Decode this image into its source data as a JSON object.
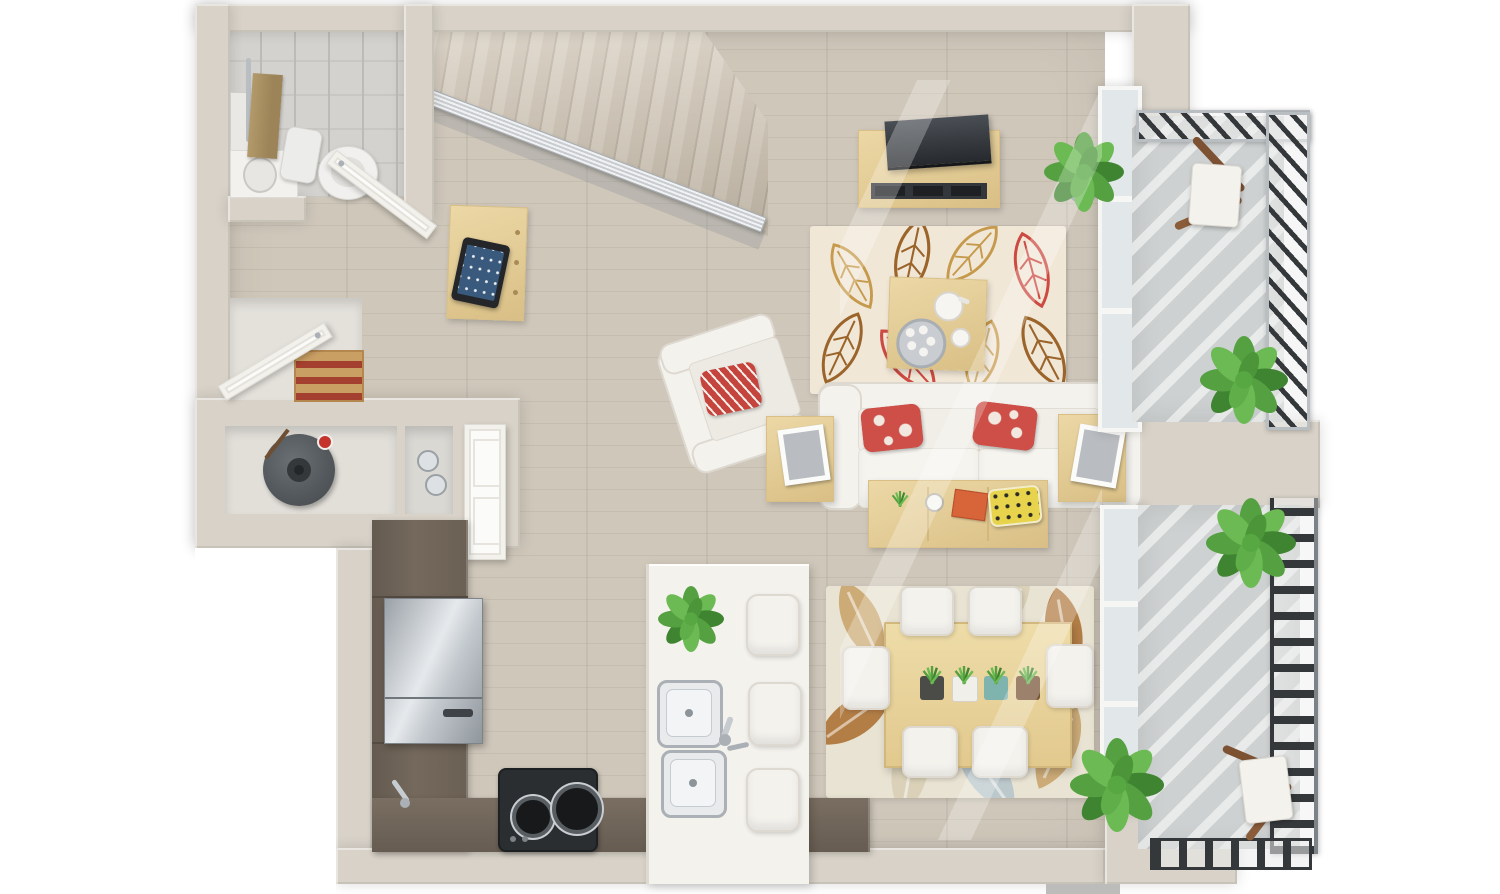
{
  "scene": {
    "title": "Top-down 3D floor plan of a loft studio apartment with two balconies",
    "type": "architectural-3d-render",
    "view": "top-down"
  },
  "palette": {
    "wall": "#d8d2c8",
    "floorWood": "#cfc7ba",
    "floorPlank": "#c5bdaf",
    "tile": "#d4d2ce",
    "tileShade": "#c9c7c3",
    "tileLine": "#bdbbb7",
    "concrete": "#ced1d1",
    "railDark": "#35383b",
    "railGrey": "#b9bec2",
    "counterDark": "#75695d",
    "woodLight": "#ecd8a6",
    "woodLightEdge": "#d9bf85",
    "white": "#f4f2ed",
    "whiteEdge": "#ddd9d1",
    "fridgeHi": "#e6e9ec",
    "glass": "#e2e7e9",
    "frame": "#f6f6f4",
    "rugCream": "#f1e7d7",
    "rugDining": "#e9e3d3",
    "leafTan": "#c69a4c",
    "leafBrown": "#9a642a",
    "leafRed": "#cc4a42",
    "leafBlue": "#b3c4cb",
    "leafPale": "#d8cfb4",
    "leafTan2": "#c8a268",
    "leafBrown2": "#aa6d2e",
    "red": "#cd4f47",
    "orange": "#d8653a",
    "yellow": "#e8d44c",
    "green": "#55a041",
    "greenLight": "#6cba53",
    "greenDark": "#3f8531",
    "towel": "#b29a6b",
    "heater": "#53585c",
    "screen": "#3a5a7d",
    "stairTread": "#d6ccbc",
    "stairEdge": "#b9ae9d",
    "mat": "#bcbcba"
  },
  "floor_plan": {
    "rooms": [
      {
        "name": "bathroom",
        "items": [
          "toilet",
          "vanity-sink",
          "mirror",
          "towel-rack"
        ]
      },
      {
        "name": "staircase",
        "treads": 13,
        "railing": "grey-metal-horizontal-bars"
      },
      {
        "name": "hallway",
        "items": [
          "entry-door",
          "closet-door",
          "shoe-cubby",
          "dresser",
          "tablet"
        ]
      },
      {
        "name": "utility-closet",
        "items": [
          "water-heater"
        ]
      },
      {
        "name": "display-niche",
        "items": [
          "glassware"
        ]
      },
      {
        "name": "kitchen",
        "items": [
          "l-shaped-dark-counter",
          "refrigerator",
          "two-burner-cooktop",
          "corner-faucet",
          "white-island",
          "double-sink",
          "bar-stools"
        ],
        "bar_stools": 3
      },
      {
        "name": "living-room",
        "items": [
          "white-sofa",
          "armchair",
          "coffee-table",
          "tv-console",
          "flat-screen-tv",
          "console-table",
          "side-table-left",
          "side-table-right",
          "leaf-outline-rug",
          "floor-plant"
        ],
        "sofa_pillows": 2
      },
      {
        "name": "dining-area",
        "items": [
          "light-wood-table",
          "white-chairs",
          "leaf-pattern-rug",
          "mini-planters"
        ],
        "chairs": 6,
        "planters": 4
      },
      {
        "name": "balcony-upper",
        "items": [
          "folding-bistro-chair",
          "potted-plant",
          "diagonal-slat-railing"
        ]
      },
      {
        "name": "balcony-lower",
        "items": [
          "folding-bistro-chair",
          "potted-plant",
          "rung-railing"
        ]
      }
    ],
    "plants_total": 7
  }
}
